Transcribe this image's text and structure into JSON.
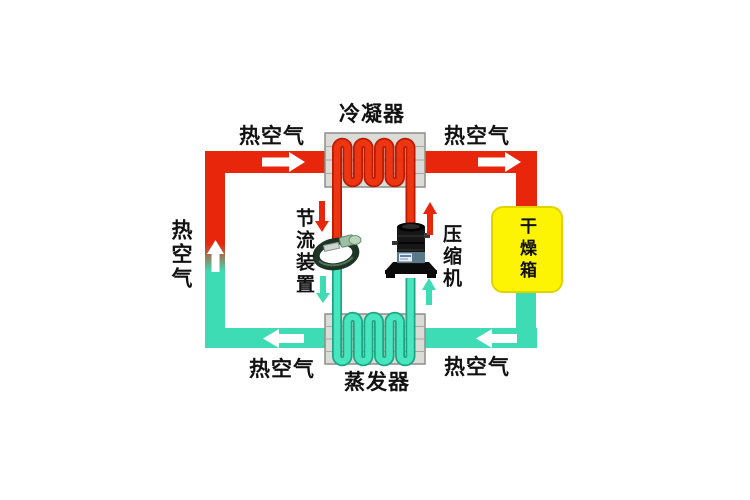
{
  "diagram": {
    "type": "heat-pump-drying-system-schematic",
    "components": {
      "condenser": {
        "label": "冷凝器"
      },
      "evaporator": {
        "label": "蒸发器"
      },
      "compressor": {
        "label": "压缩机"
      },
      "throttle_device": {
        "label": "节流装置"
      },
      "drying_box": {
        "label": "干燥箱"
      }
    },
    "air_labels": {
      "top_left": "热空气",
      "top_right": "热空气",
      "left": "热空气",
      "bottom_left": "热空气",
      "bottom_right": "热空气"
    },
    "icons": {
      "compressor_image": "scroll-compressor-photo",
      "throttle_image": "capillary-coil-throttle-photo",
      "flow_arrows_air": "white-arrow",
      "flow_arrows_hot_refrigerant": "red-arrow",
      "flow_arrows_cold_refrigerant": "cyan-arrow"
    },
    "colors": {
      "hot_pipe": "#e8260c",
      "cold_pipe": "#3edcb4",
      "coil_hot_edge": "#bb1a02",
      "coil_cold_edge": "#1fa583",
      "drying_box_fill": "#fcf402",
      "drying_box_border": "#e3d200",
      "exchanger_fill": "#dbdbd7",
      "exchanger_border": "#8e8e88",
      "exchanger_fin": "#a9a9a3",
      "air_arrow": "#ffffff",
      "text": "#111111",
      "background": "#ffffff"
    },
    "flow": {
      "air_loop_direction": "clockwise",
      "top_pipe": "hot",
      "bottom_pipe": "cold",
      "left_pipe": "cold-to-hot-gradient"
    }
  }
}
